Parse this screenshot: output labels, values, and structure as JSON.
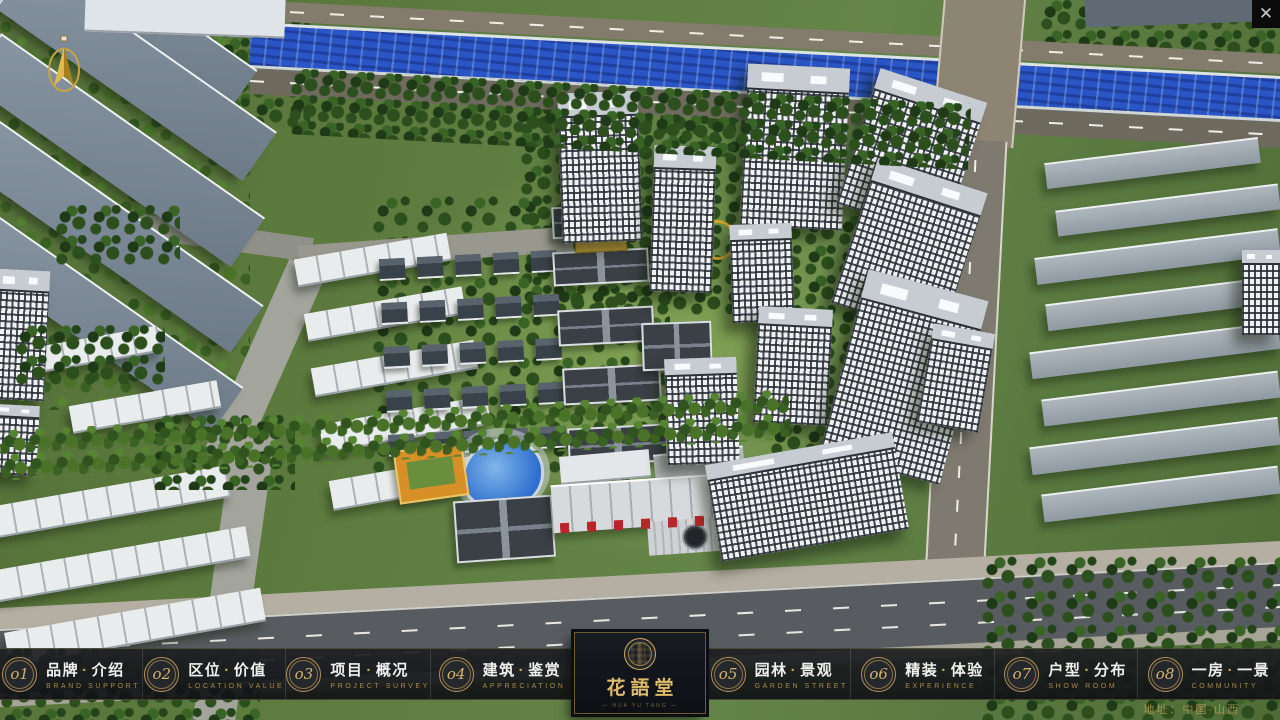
{
  "window": {
    "close_label": "✕"
  },
  "nav": {
    "dot": "·",
    "items": [
      {
        "num": "o1",
        "zh1": "品牌",
        "zh2": "介绍",
        "en": "BRAND SUPPORT"
      },
      {
        "num": "o2",
        "zh1": "区位",
        "zh2": "价值",
        "en": "LOCATION VALUE"
      },
      {
        "num": "o3",
        "zh1": "项目",
        "zh2": "概况",
        "en": "PROJECT SURVEY"
      },
      {
        "num": "o4",
        "zh1": "建筑",
        "zh2": "鉴赏",
        "en": "APPRECIATION"
      },
      {
        "num": "o5",
        "zh1": "园林",
        "zh2": "景观",
        "en": "GARDEN STREET"
      },
      {
        "num": "o6",
        "zh1": "精装",
        "zh2": "体验",
        "en": "EXPERIENCE"
      },
      {
        "num": "o7",
        "zh1": "户型",
        "zh2": "分布",
        "en": "SHOW ROOM"
      },
      {
        "num": "o8",
        "zh1": "一房",
        "zh2": "一景",
        "en": "COMMUNITY"
      }
    ],
    "logo": {
      "title": "花語堂",
      "subtitle": "— HUA YU TANG —"
    },
    "address": "地址：中国·山西"
  },
  "colors": {
    "gold": "#c9a85c",
    "bar_bg": "#17191c",
    "river": "#2a55c5"
  }
}
